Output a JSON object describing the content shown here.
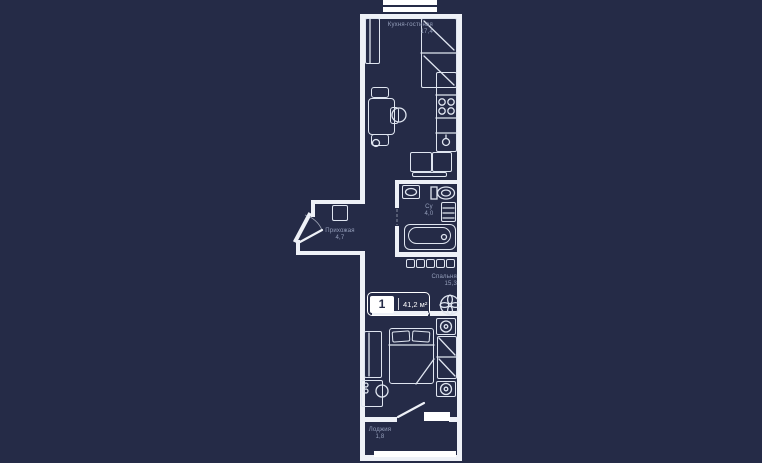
{
  "colors": {
    "bg": "#252b47",
    "wall": "#eef1f7",
    "window": "#ffffff",
    "line": "#dfe5f0",
    "label": "#959fbb",
    "badge_navy": "#252b47"
  },
  "plan": {
    "badge": {
      "rooms_count": "1",
      "total_area": "41,2 м²"
    },
    "rooms": {
      "kitchen_living": {
        "name": "Кухня-гостиная",
        "area": "17,4"
      },
      "hallway": {
        "name": "Прихожая",
        "area": "4,7"
      },
      "bathroom": {
        "name": "Су",
        "area": "4,0"
      },
      "bedroom": {
        "name": "Спальня",
        "area": "15,3"
      },
      "loggia": {
        "name": "Лоджия",
        "area": "1,8"
      }
    },
    "icons": {
      "ventilation": "fan-icon",
      "lamp": "circle-lamp-icon",
      "window": "double-white-strip"
    }
  }
}
